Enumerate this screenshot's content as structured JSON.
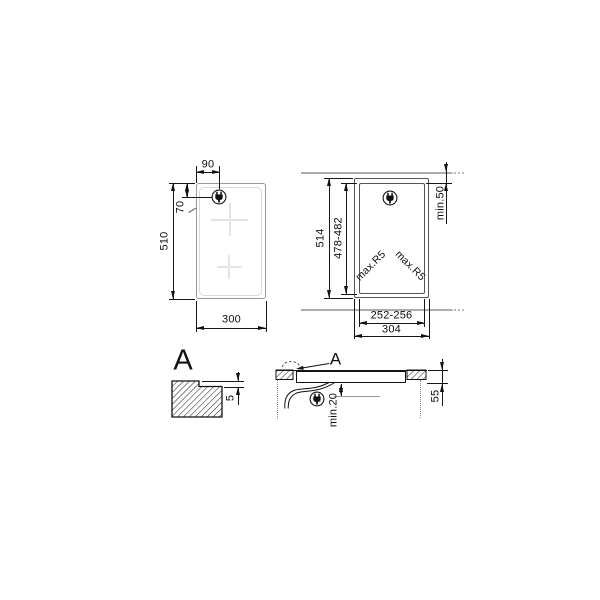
{
  "colors": {
    "line": "#161616",
    "product_outline": "#999999",
    "inner_glass_outline": "#d9d9d9",
    "zone_cross": "#e4e4e4",
    "wall_line": "#adadad",
    "background": "#ffffff"
  },
  "icons": {
    "plug": "power-plug-icon"
  },
  "top_view": {
    "plug_offset_x": "90",
    "plug_offset_y": "70",
    "depth": "510",
    "width": "300"
  },
  "cutout_view": {
    "recess_depth": "514",
    "cutout_depth": "478-482",
    "min_rear_clearance": "min.50",
    "corner_radius_left": "max.R5",
    "corner_radius_right": "max.R5",
    "cutout_width": "252-256",
    "recess_width": "304"
  },
  "detail_view": {
    "label": "A",
    "recess_step_depth": "5"
  },
  "section_view": {
    "label": "A",
    "min_clearance_below": "min.20",
    "built_in_height": "55"
  }
}
